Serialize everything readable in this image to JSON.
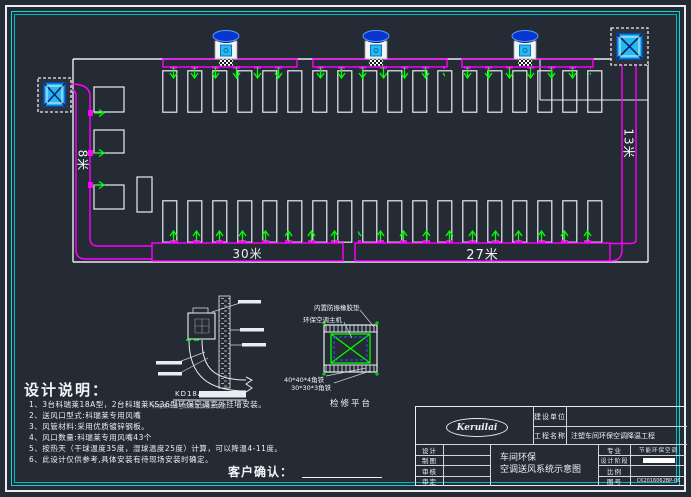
{
  "colors": {
    "background": "#242b34",
    "wall": "#e9edf1",
    "duct": "#ff00ff",
    "outlet": "#00ff00",
    "border_cyan": "#00dcdc",
    "unit_cyan": "#29b9ef",
    "unit_cap_blue": "#0635cf"
  },
  "plan": {
    "dim_left_vertical": "8米",
    "dim_right_vertical": "13米",
    "dim_bottom_left": "30米",
    "dim_bottom_right": "27米"
  },
  "details": {
    "wall_mount": {
      "title": "KD18A",
      "caption": "科瑞莱环保空调侧墙安装示意图"
    },
    "platform": {
      "label_rubber": "内置防振橡胶垫",
      "label_host": "环保空调主机",
      "label_angle_40": "40*40*4角铁",
      "label_angle_30": "30*30*3角铁",
      "title": "检修平台"
    }
  },
  "notes": {
    "title": "设计说明：",
    "items": [
      "1、3台科瑞莱18A型，2台科瑞莱KS36型环保空调室外挂墙安装。",
      "2、送风口型式:科瑞莱专用风嘴",
      "3、风管材料:采用优质镀锌钢板。",
      "4、风口数量:科瑞莱专用风嘴43个",
      "5、按热天（干球温度35度，湿球温度25度）计算，可以降温4-11度。",
      "6、此设计仅供参考,具体安装有待现场安装时确定。"
    ]
  },
  "customer_confirm": {
    "label": "客户确认："
  },
  "titleblock": {
    "logo_text": "Keruilai",
    "build_unit_label": "建设单位",
    "build_unit_value": "",
    "project_label": "工程名称",
    "project_value": "注塑车间环保空调降温工程",
    "left_rows": [
      "设计",
      "制图",
      "审核",
      "审定"
    ],
    "drawing_title_line1": "车间环保",
    "drawing_title_line2": "空调送风系统示意图",
    "right_rows": [
      {
        "label": "专业",
        "value": "节能环保空调"
      },
      {
        "label": "设计阶段",
        "value": ""
      },
      {
        "label": "比例",
        "value": ""
      },
      {
        "label": "图号",
        "value": "CK2016062BP-06"
      }
    ]
  }
}
